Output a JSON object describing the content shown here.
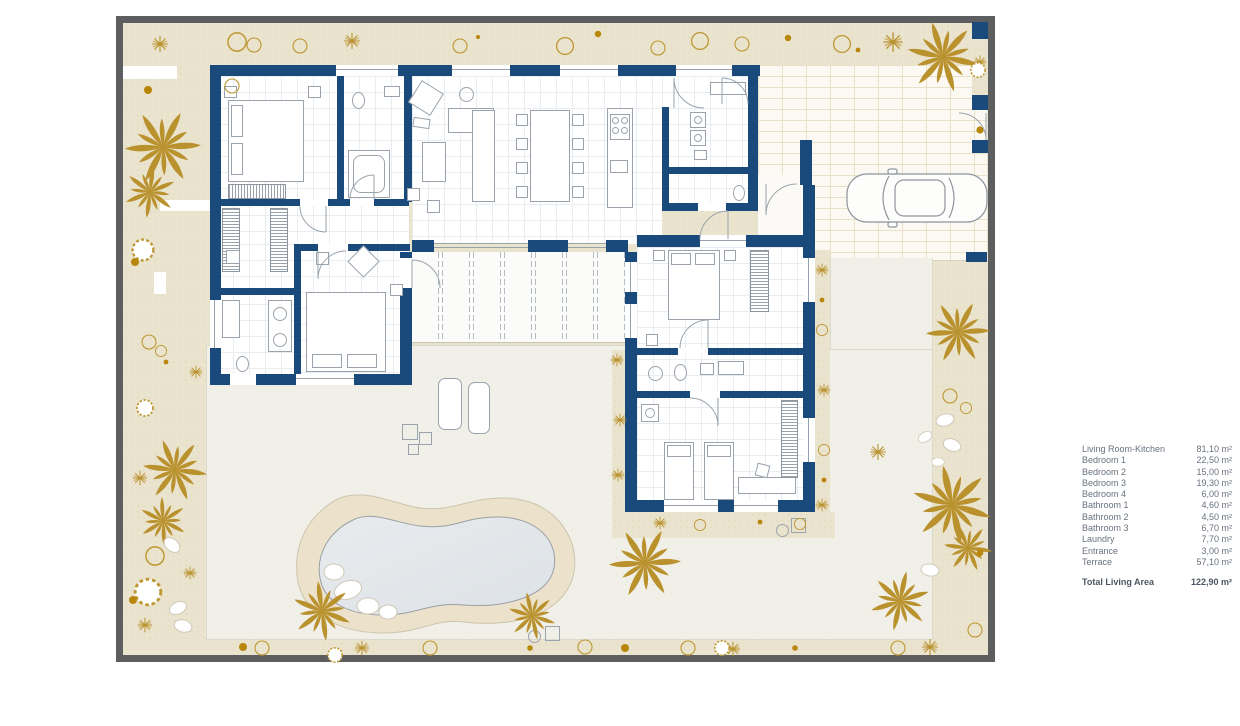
{
  "legend": {
    "rows": [
      {
        "label": "Living Room-Kitchen",
        "area": "81,10 m²"
      },
      {
        "label": "Bedroom 1",
        "area": "22,50 m²"
      },
      {
        "label": "Bedroom 2",
        "area": "15,00 m²"
      },
      {
        "label": "Bedroom 3",
        "area": "19,30 m²"
      },
      {
        "label": "Bedroom 4",
        "area": "6,00 m²"
      },
      {
        "label": "Bathroom 1",
        "area": "4,60 m²"
      },
      {
        "label": "Bathroom 2",
        "area": "4,50 m²"
      },
      {
        "label": "Bathroom 3",
        "area": "6,70 m²"
      },
      {
        "label": "Laundry",
        "area": "7,70 m²"
      },
      {
        "label": "Entrance",
        "area": "3,00 m²"
      },
      {
        "label": "Terrace",
        "area": "57,10 m²"
      }
    ],
    "total": {
      "label": "Total Living Area",
      "area": "122,90 m²"
    }
  },
  "colors": {
    "wall_navy": "#1a4a7c",
    "plot_boundary_gray": "#5c5e5f",
    "garden_beige": "#eae3cd",
    "plant_gold": "#b9912d",
    "patio_white": "#f0efe8",
    "pool_water": "#e3e7ea",
    "pool_deck_sand": "#ece2cc",
    "furniture_gray": "#9aa3ac"
  },
  "icons": {
    "palm_tree": "radial gold fronds",
    "shrub": "gold star burst",
    "bush": "gold outlined circle",
    "stone": "white ellipse",
    "car": "top-view car outline"
  }
}
